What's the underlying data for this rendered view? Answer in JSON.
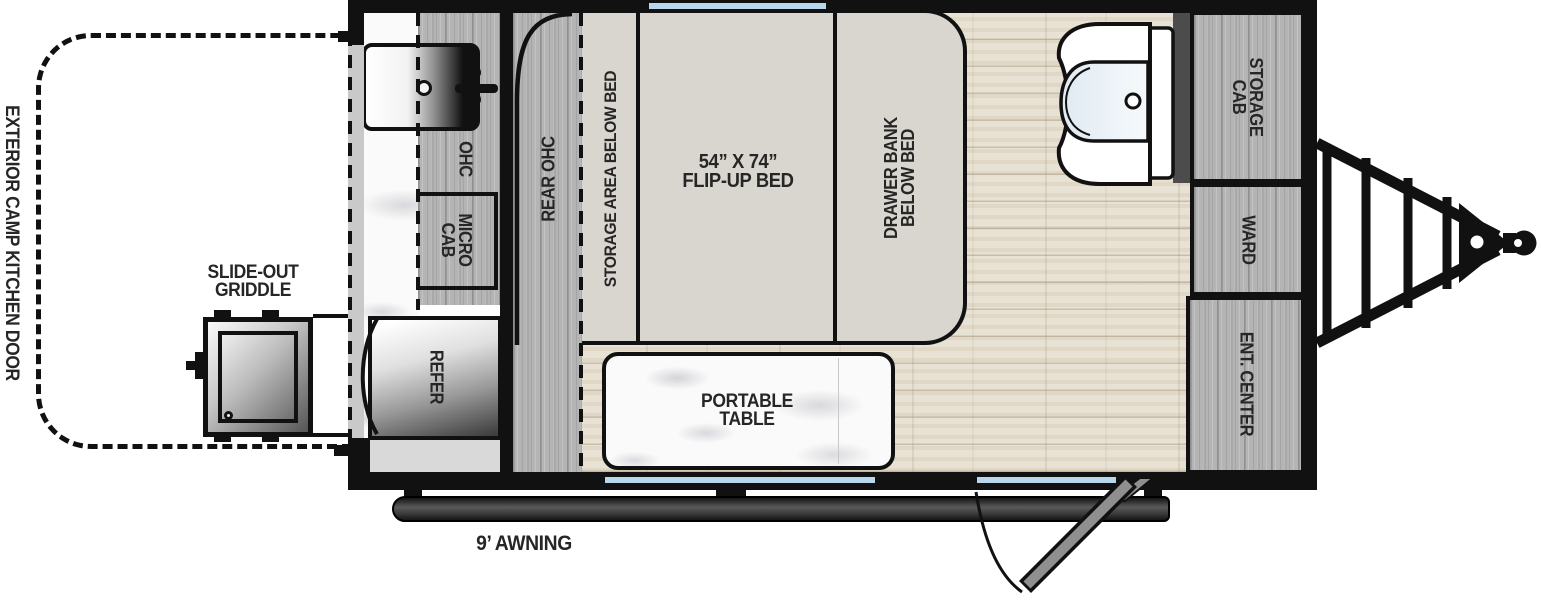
{
  "floorplan": {
    "title": "travel trailer floorplan",
    "labels": {
      "exterior_camp_kitchen_door": "EXTERIOR CAMP KITCHEN DOOR",
      "slide_out_griddle_line1": "SLIDE-OUT",
      "slide_out_griddle_line2": "GRIDDLE",
      "awning": "9’ AWNING",
      "ohc": "OHC",
      "micro_cab_line1": "MICRO",
      "micro_cab_line2": "CAB",
      "refer": "REFER",
      "rear_ohc": "REAR OHC",
      "storage_area_below_bed": "STORAGE AREA BELOW BED",
      "bed_size": "54” X 74”",
      "bed_type": "FLIP-UP BED",
      "drawer_bank_line1": "DRAWER BANK",
      "drawer_bank_line2": "BELOW BED",
      "portable_table_line1": "PORTABLE",
      "portable_table_line2": "TABLE",
      "storage_cab_line1": "STORAGE",
      "storage_cab_line2": "CAB",
      "ward": "WARD",
      "ent_center": "ENT. CENTER"
    },
    "colors": {
      "window_blue": "#b9d7ec",
      "cabinet_wood_gray": "#b4b4b4",
      "floor_wood_light": "#e8e2d4",
      "bed_beige": "#d9d6cf",
      "wall_black": "#111111",
      "interior_wall_gray": "#4c4c4c",
      "awning_dark_gray": "#3a3a3a",
      "entry_door_gray": "#8f8f8f"
    }
  }
}
